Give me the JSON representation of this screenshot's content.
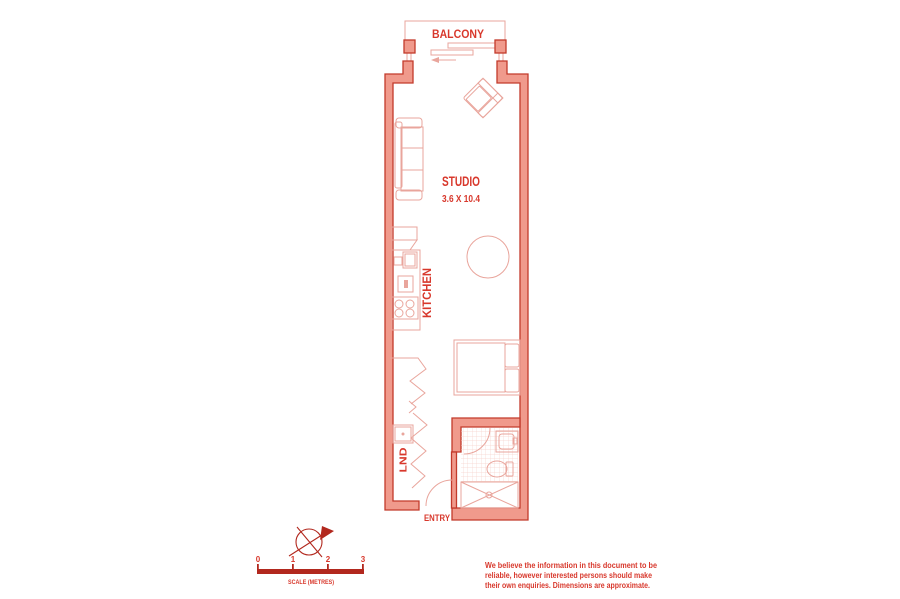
{
  "plan": {
    "balcony_label": "BALCONY",
    "studio": {
      "label": "STUDIO",
      "dimensions": "3.6 X 10.4"
    },
    "kitchen_label": "KITCHEN",
    "laundry_label": "LND",
    "entry_label": "ENTRY"
  },
  "scale_bar": {
    "tick_labels": [
      "0",
      "1",
      "2",
      "3"
    ],
    "caption": "SCALE (METRES)"
  },
  "compass": {
    "icon": "compass-rose-icon"
  },
  "disclaimer": {
    "line1": "We believe the information in this document to be",
    "line2": "reliable, however interested persons should make",
    "line3": "their own enquiries. Dimensions are approximate."
  },
  "colors": {
    "wall_fill": "#F09A8C",
    "wall_outline": "#C23A2B",
    "furniture_line": "#E9A59C",
    "tile_line": "#F6D3CD",
    "text_red": "#D8382C",
    "solid_red": "#B2281E"
  }
}
